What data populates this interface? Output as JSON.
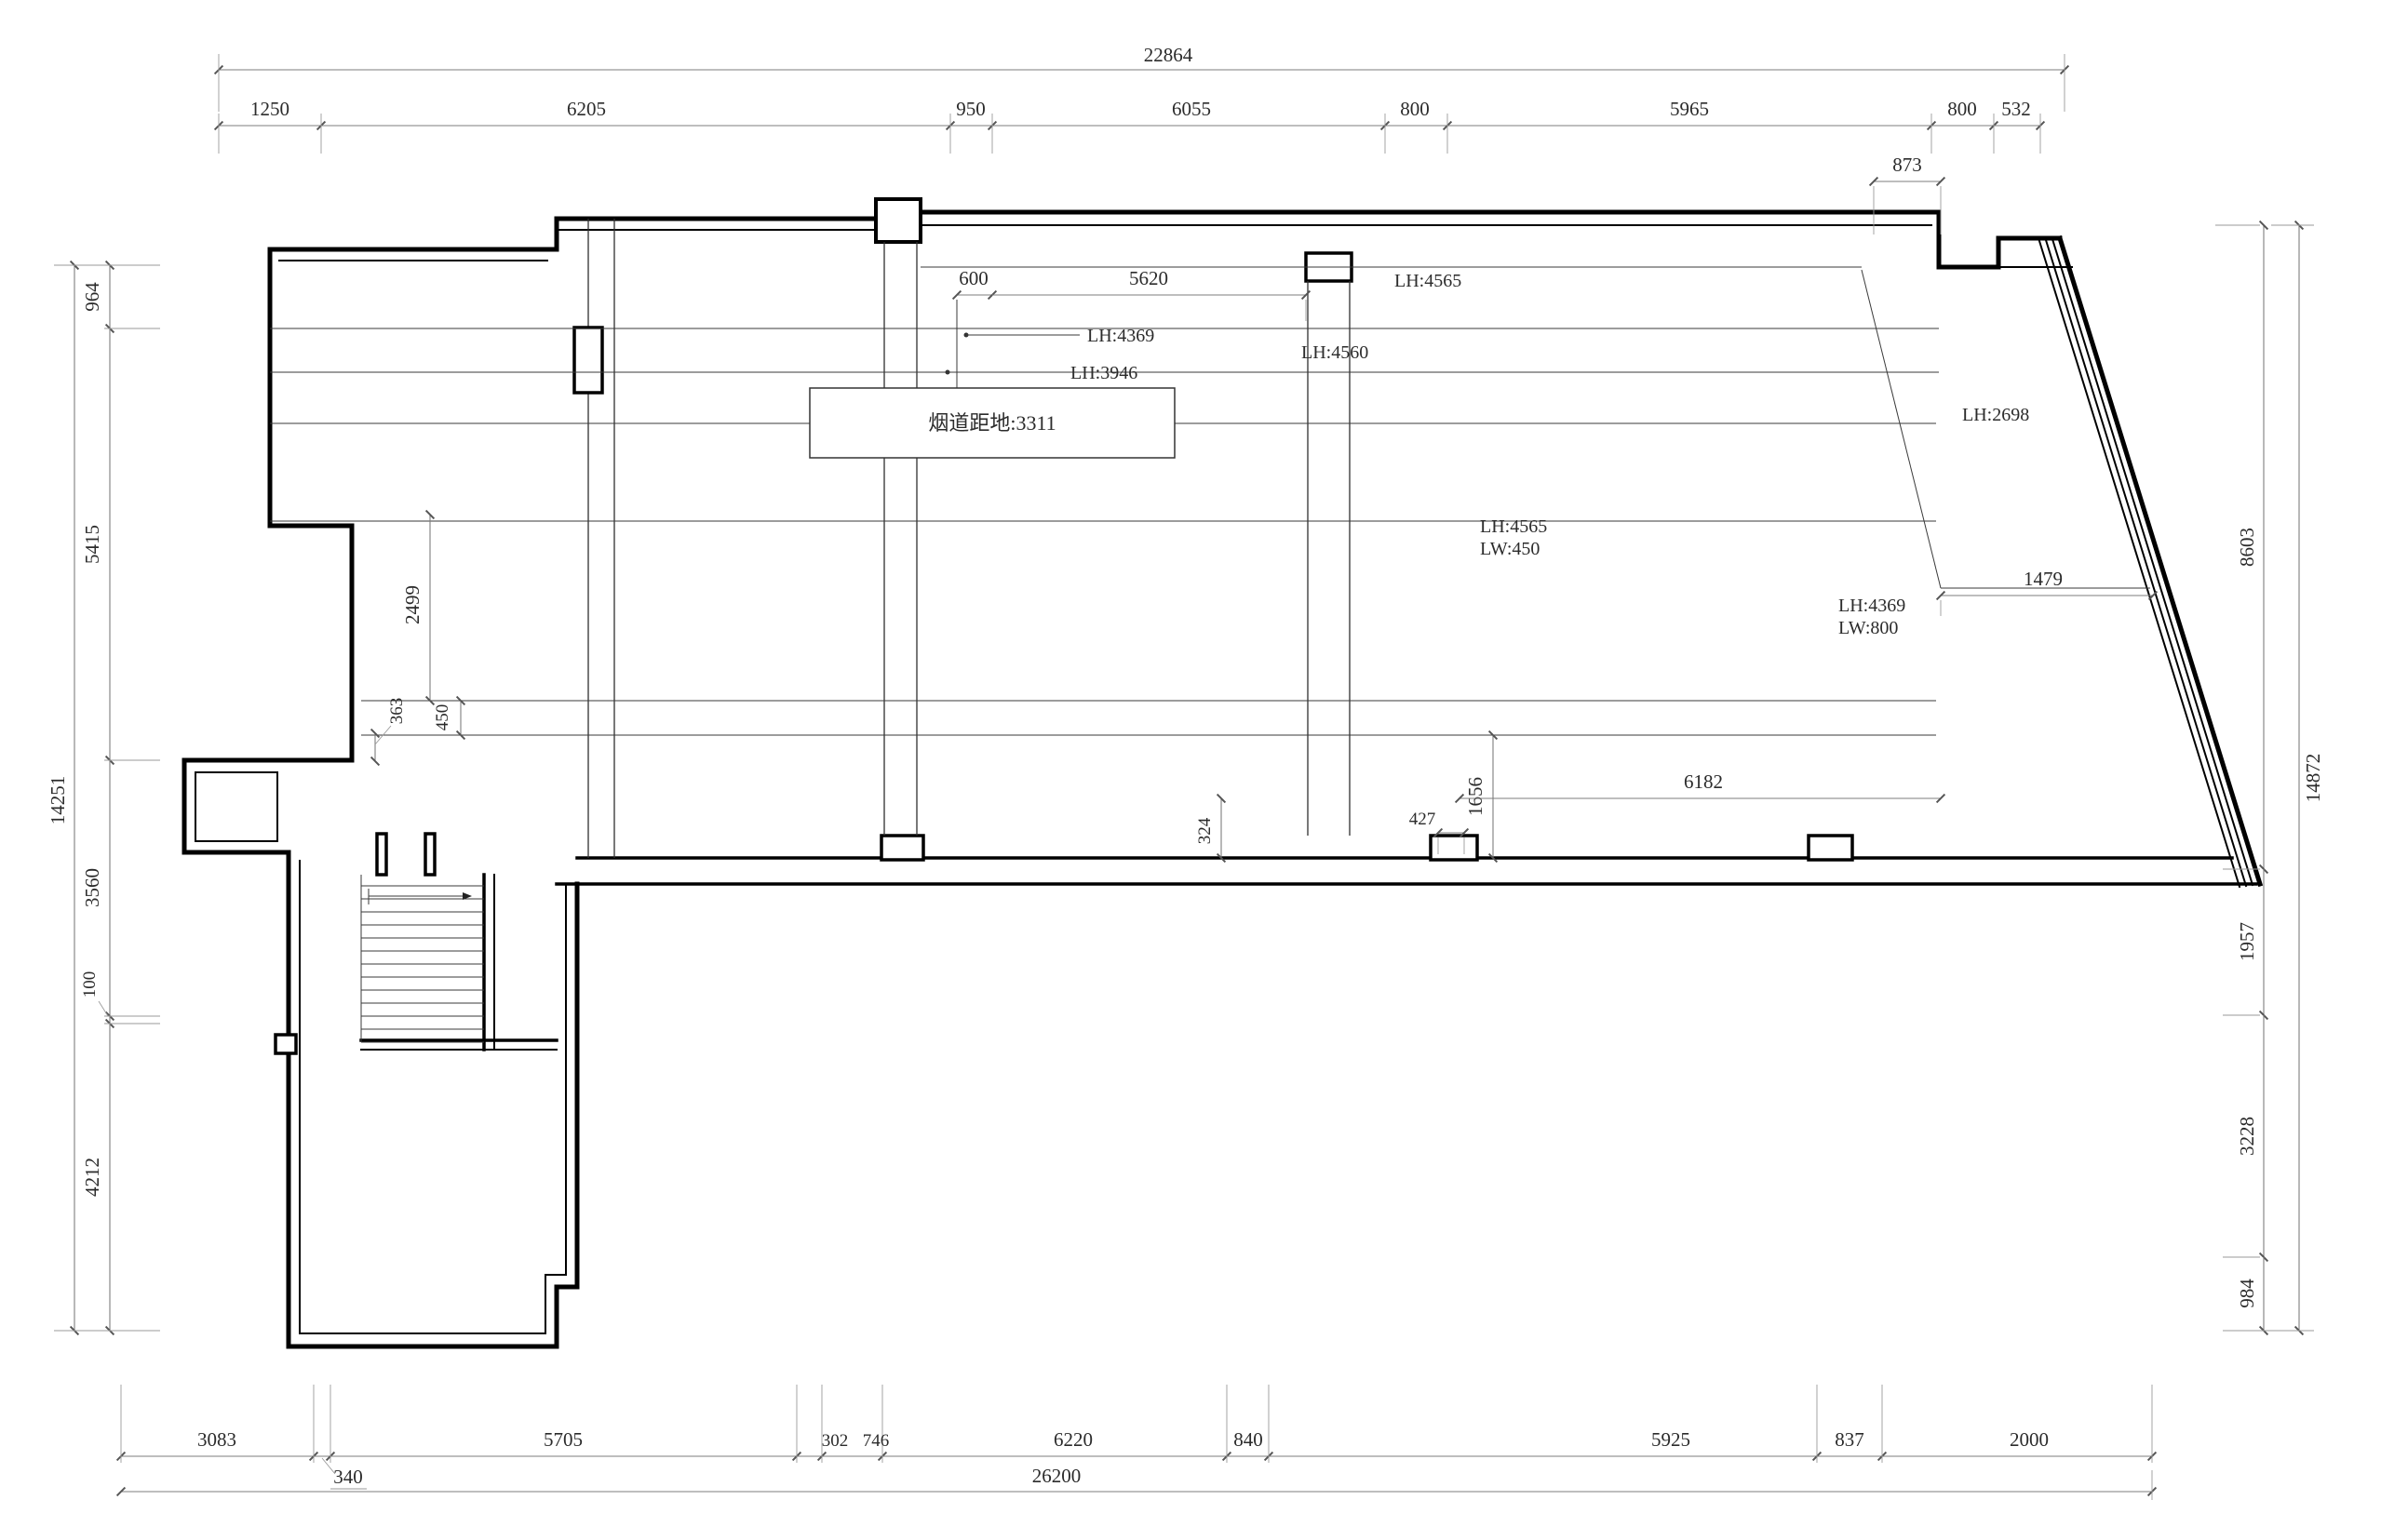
{
  "drawing": {
    "duct_label": "烟道距地:3311",
    "room_labels": {
      "lh4369_top": "LH:4369",
      "lh3946": "LH:3946",
      "lh4565_top": "LH:4565",
      "lh4560": "LH:4560",
      "lh4565_mid": "LH:4565",
      "lw450": "LW:450",
      "lh4369_right": "LH:4369",
      "lw800": "LW:800",
      "lh2698": "LH:2698"
    }
  },
  "dims": {
    "top": {
      "overall": "22864",
      "seg": [
        "1250",
        "6205",
        "950",
        "6055",
        "800",
        "5965",
        "800",
        "532"
      ],
      "notch": "873"
    },
    "left": {
      "overall": "14251",
      "seg": [
        "964",
        "5415",
        "3560",
        "100",
        "4212"
      ]
    },
    "right": {
      "overall": "14872",
      "seg": [
        "8603",
        "1957",
        "3228",
        "984"
      ]
    },
    "bottom": {
      "overall": "26200",
      "seg": [
        "3083",
        "5705",
        "302",
        "746",
        "6220",
        "840",
        "5925",
        "837",
        "2000"
      ],
      "offset": "340"
    },
    "interior": {
      "d600": "600",
      "d5620": "5620",
      "d2499": "2499",
      "d450": "450",
      "d363": "363",
      "d324": "324",
      "d427": "427",
      "d1656": "1656",
      "d6182": "6182",
      "d1479": "1479"
    }
  }
}
